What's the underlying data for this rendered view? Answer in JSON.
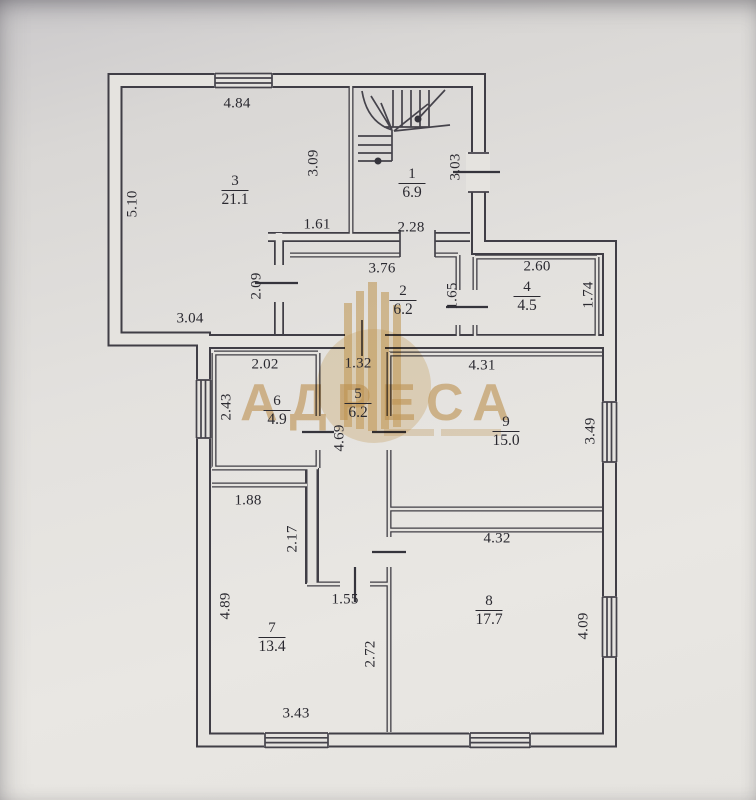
{
  "plan": {
    "rooms": {
      "room1": {
        "number": "1",
        "area": "6.9"
      },
      "room2": {
        "number": "2",
        "area": "6.2"
      },
      "room3": {
        "number": "3",
        "area": "21.1"
      },
      "room4": {
        "number": "4",
        "area": "4.5"
      },
      "room5": {
        "number": "5",
        "area": "6.2"
      },
      "room6": {
        "number": "6",
        "area": "4.9"
      },
      "room7": {
        "number": "7",
        "area": "13.4"
      },
      "room8": {
        "number": "8",
        "area": "17.7"
      },
      "room9": {
        "number": "9",
        "area": "15.0"
      }
    },
    "dims": {
      "room3_top": "4.84",
      "room3_left": "5.10",
      "room3_right": "3.09",
      "room3_step": "1.61",
      "room3_bottom": "3.04",
      "room3_notch": "2.09",
      "room1_width": "2.28",
      "room1_right": "3.03",
      "room2_top": "3.76",
      "room2_right": "1.65",
      "room4_top": "2.60",
      "room4_right": "1.74",
      "room6_top": "2.02",
      "room6_left": "2.43",
      "room5_top": "1.32",
      "room5_left": "4.69",
      "room9_top": "4.31",
      "room9_right": "3.49",
      "room7_top": "1.88",
      "room7_notch": "2.17",
      "room7_left": "4.89",
      "room7_mid": "1.55",
      "room7_right": "2.72",
      "room7_bottom": "3.43",
      "room8_top": "4.32",
      "room8_right": "4.09"
    },
    "watermark": {
      "text": "АДРЕСА",
      "color": "#d2a259"
    }
  }
}
